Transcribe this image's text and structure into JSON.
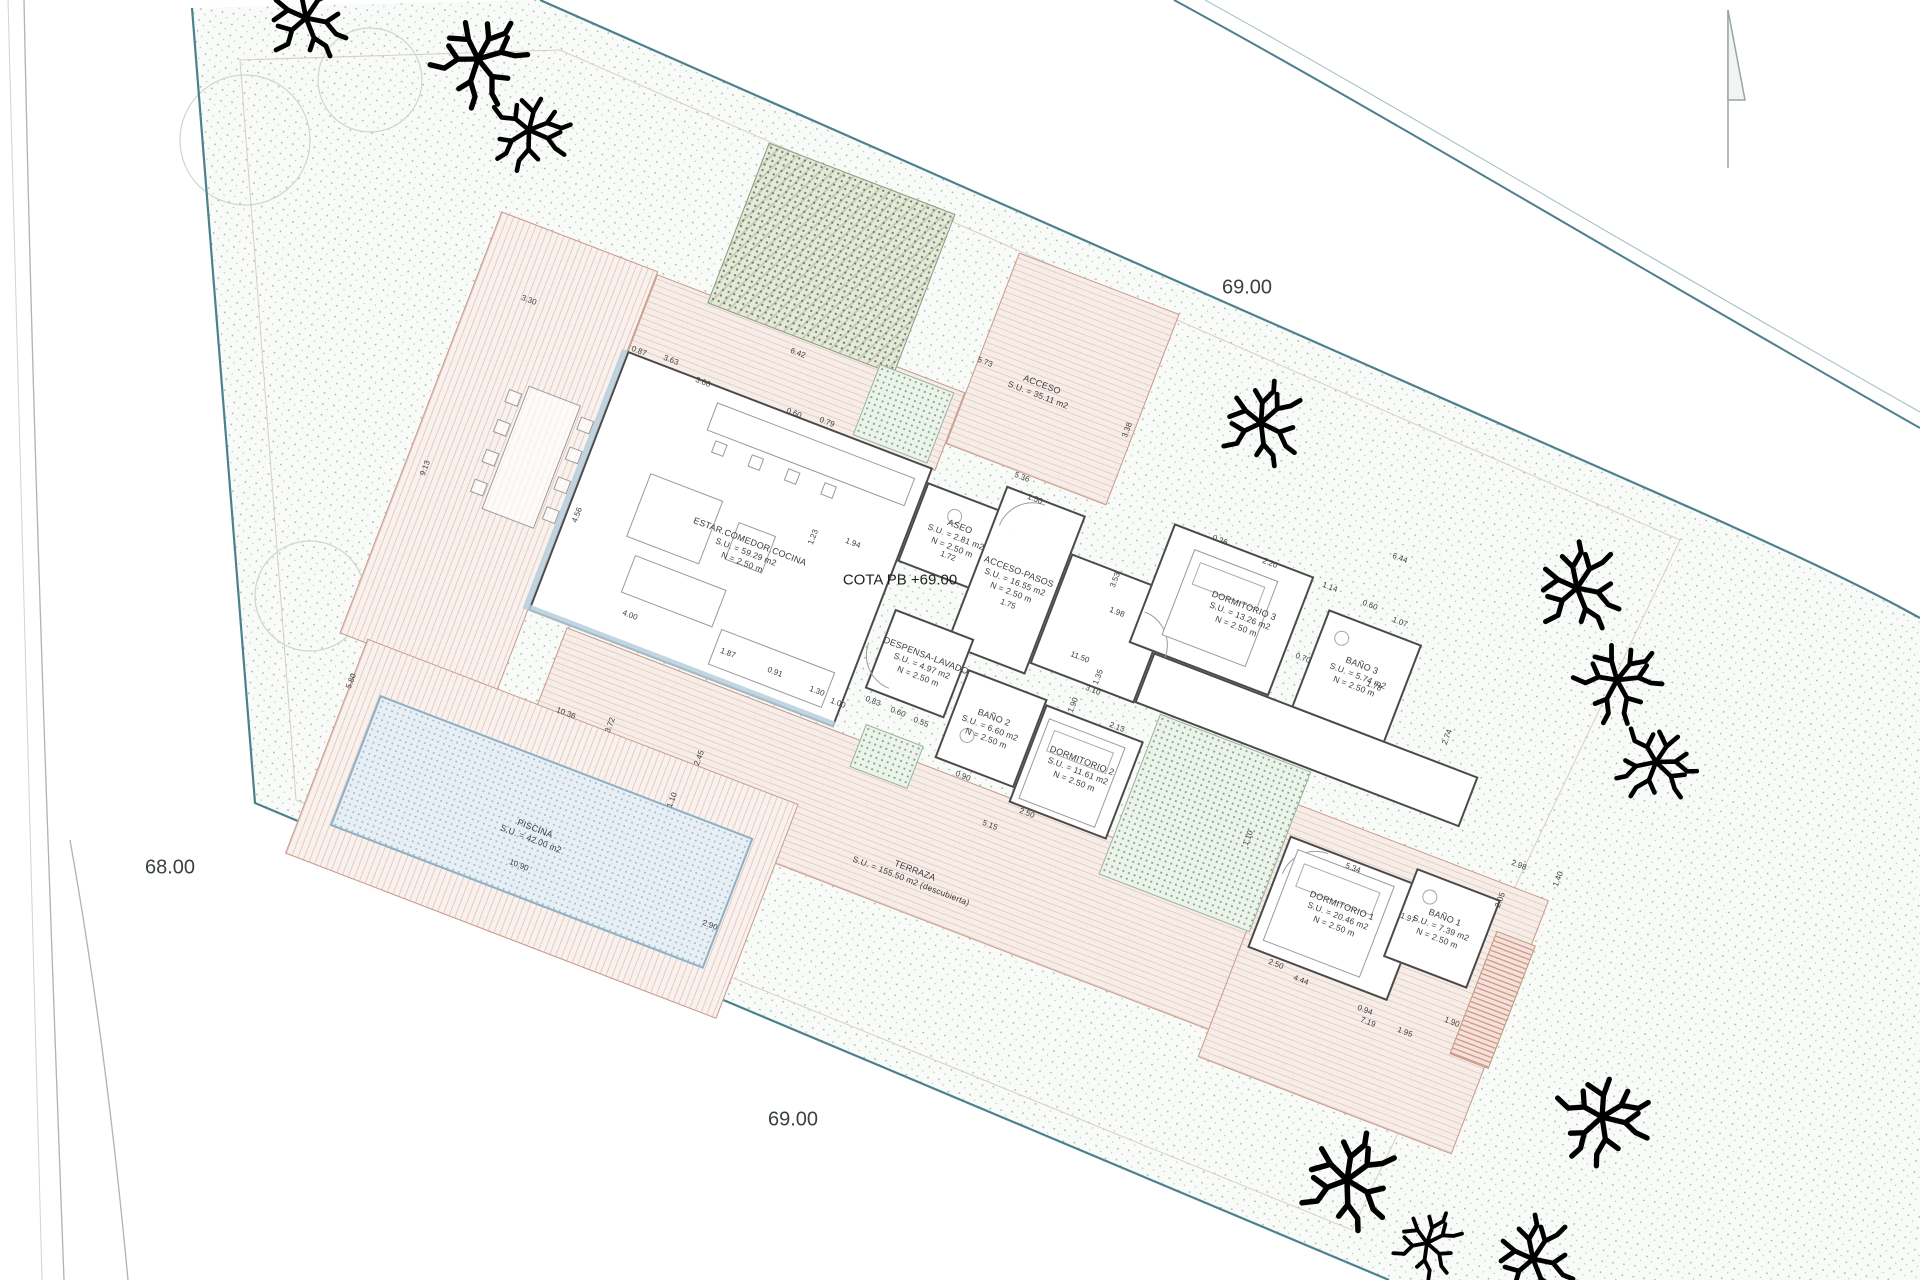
{
  "drawing": {
    "cota_label": "COTA PB +69.00",
    "elevations": {
      "top": "69.00",
      "left": "68.00",
      "bottom": "69.00"
    }
  },
  "rooms": [
    {
      "name": "ESTAR.COMEDOR.COCINA",
      "area": "S.U. = 59.29 m2",
      "height": "N = 2.50 m"
    },
    {
      "name": "ASEO",
      "area": "S.U. = 2.81 m2",
      "height": "N = 2.50 m"
    },
    {
      "name": "ACCESO-PASOS",
      "area": "S.U. = 16.55 m2",
      "height": "N = 2.50 m"
    },
    {
      "name": "DESPENSA-LAVADO",
      "area": "S.U. = 4.97 m2",
      "height": "N = 2.50 m"
    },
    {
      "name": "BAÑO 2",
      "area": "S.U. = 6.60 m2",
      "height": "N = 2.50 m"
    },
    {
      "name": "DORMITORIO 2",
      "area": "S.U. = 11.61 m2",
      "height": "N = 2.50 m"
    },
    {
      "name": "DORMITORIO 3",
      "area": "S.U. = 13.26 m2",
      "height": "N = 2.50 m"
    },
    {
      "name": "BAÑO 3",
      "area": "S.U. = 5.74 m2",
      "height": "N = 2.50 m"
    },
    {
      "name": "DORMITORIO 1",
      "area": "S.U. = 20.46 m2",
      "height": "N = 2.50 m"
    },
    {
      "name": "BAÑO 1",
      "area": "S.U. = 7.39 m2",
      "height": "N = 2.50 m"
    },
    {
      "name": "ACCESO",
      "area": "S.U. = 35.11 m2",
      "height": ""
    },
    {
      "name": "PISCINA",
      "area": "S.U. = 42.00 m2",
      "height": ""
    },
    {
      "name": "TERRAZA",
      "area": "S.U. = 155.50 m2 (descubierta)",
      "height": ""
    }
  ],
  "dimensions": [
    {
      "v": "3.30",
      "x": 529,
      "y": 300,
      "r": 21
    },
    {
      "v": "0.87",
      "x": 639,
      "y": 351,
      "r": 21
    },
    {
      "v": "3.63",
      "x": 671,
      "y": 360,
      "r": 21
    },
    {
      "v": "3.66",
      "x": 703,
      "y": 382,
      "r": 21
    },
    {
      "v": "6.42",
      "x": 798,
      "y": 353,
      "r": 21
    },
    {
      "v": "0.60",
      "x": 794,
      "y": 413,
      "r": 21
    },
    {
      "v": "0.79",
      "x": 827,
      "y": 422,
      "r": 21
    },
    {
      "v": "5.73",
      "x": 985,
      "y": 362,
      "r": 21
    },
    {
      "v": "3.38",
      "x": 1127,
      "y": 430,
      "r": -69
    },
    {
      "v": "5.36",
      "x": 1022,
      "y": 477,
      "r": 21
    },
    {
      "v": "1.50",
      "x": 1035,
      "y": 499,
      "r": 21
    },
    {
      "v": "9.13",
      "x": 425,
      "y": 468,
      "r": -69
    },
    {
      "v": "4.56",
      "x": 577,
      "y": 515,
      "r": -69
    },
    {
      "v": "1.23",
      "x": 813,
      "y": 537,
      "r": -69
    },
    {
      "v": "1.94",
      "x": 853,
      "y": 543,
      "r": 21
    },
    {
      "v": "1.72",
      "x": 948,
      "y": 556,
      "r": 21
    },
    {
      "v": "1.75",
      "x": 1008,
      "y": 604,
      "r": 21
    },
    {
      "v": "0.36",
      "x": 1220,
      "y": 540,
      "r": 21
    },
    {
      "v": "2.20",
      "x": 1270,
      "y": 563,
      "r": 21
    },
    {
      "v": "6.44",
      "x": 1400,
      "y": 558,
      "r": 21
    },
    {
      "v": "1.14",
      "x": 1330,
      "y": 587,
      "r": 21
    },
    {
      "v": "0.60",
      "x": 1370,
      "y": 605,
      "r": 21
    },
    {
      "v": "1.07",
      "x": 1400,
      "y": 622,
      "r": 21
    },
    {
      "v": "0.70",
      "x": 1303,
      "y": 658,
      "r": 21
    },
    {
      "v": "1.78",
      "x": 1374,
      "y": 686,
      "r": 21
    },
    {
      "v": "2.74",
      "x": 1447,
      "y": 737,
      "r": -69
    },
    {
      "v": "3.53",
      "x": 1115,
      "y": 580,
      "r": -69
    },
    {
      "v": "1.98",
      "x": 1117,
      "y": 612,
      "r": 21
    },
    {
      "v": "4.00",
      "x": 630,
      "y": 615,
      "r": 21
    },
    {
      "v": "1.87",
      "x": 728,
      "y": 653,
      "r": 21
    },
    {
      "v": "0.91",
      "x": 775,
      "y": 672,
      "r": 21
    },
    {
      "v": "1.30",
      "x": 817,
      "y": 691,
      "r": 21
    },
    {
      "v": "1.00",
      "x": 838,
      "y": 703,
      "r": 21
    },
    {
      "v": "0.83",
      "x": 873,
      "y": 701,
      "r": 21
    },
    {
      "v": "0.60",
      "x": 898,
      "y": 712,
      "r": 21
    },
    {
      "v": "0.55",
      "x": 921,
      "y": 722,
      "r": 21
    },
    {
      "v": "5.80",
      "x": 351,
      "y": 681,
      "r": -69
    },
    {
      "v": "10.36",
      "x": 566,
      "y": 713,
      "r": 21
    },
    {
      "v": "3.72",
      "x": 610,
      "y": 725,
      "r": -69
    },
    {
      "v": "2.45",
      "x": 699,
      "y": 758,
      "r": -69
    },
    {
      "v": "1.10",
      "x": 672,
      "y": 800,
      "r": -69
    },
    {
      "v": "10.90",
      "x": 519,
      "y": 865,
      "r": 21
    },
    {
      "v": "2.90",
      "x": 710,
      "y": 925,
      "r": 21
    },
    {
      "v": "11.50",
      "x": 1080,
      "y": 657,
      "r": 21
    },
    {
      "v": "1.35",
      "x": 1098,
      "y": 677,
      "r": -69
    },
    {
      "v": "3.10",
      "x": 1093,
      "y": 690,
      "r": 21
    },
    {
      "v": "1.90",
      "x": 1073,
      "y": 705,
      "r": -69
    },
    {
      "v": "2.13",
      "x": 1117,
      "y": 727,
      "r": 21
    },
    {
      "v": "5.15",
      "x": 990,
      "y": 825,
      "r": 21
    },
    {
      "v": "2.50",
      "x": 1027,
      "y": 813,
      "r": 21
    },
    {
      "v": "0.90",
      "x": 963,
      "y": 776,
      "r": 21
    },
    {
      "v": "5.34",
      "x": 1353,
      "y": 868,
      "r": 21
    },
    {
      "v": "1.10",
      "x": 1248,
      "y": 838,
      "r": -69
    },
    {
      "v": "2.98",
      "x": 1519,
      "y": 865,
      "r": 21
    },
    {
      "v": "1.40",
      "x": 1558,
      "y": 879,
      "r": -69
    },
    {
      "v": "2.05",
      "x": 1500,
      "y": 900,
      "r": -69
    },
    {
      "v": "1.97",
      "x": 1408,
      "y": 918,
      "r": 21
    },
    {
      "v": "2.50",
      "x": 1276,
      "y": 964,
      "r": 21
    },
    {
      "v": "4.44",
      "x": 1301,
      "y": 980,
      "r": 21
    },
    {
      "v": "0.94",
      "x": 1365,
      "y": 1010,
      "r": 21
    },
    {
      "v": "1.95",
      "x": 1405,
      "y": 1032,
      "r": 21
    },
    {
      "v": "7.19",
      "x": 1368,
      "y": 1022,
      "r": 21
    },
    {
      "v": "1.90",
      "x": 1452,
      "y": 1022,
      "r": 21
    }
  ],
  "colors": {
    "boundary": "#4d808d",
    "deck_hatch": "#c7998a",
    "green_stipple": "#7fa382",
    "pool_edge": "#8fb0c2",
    "wall": "#4a4a4a"
  }
}
